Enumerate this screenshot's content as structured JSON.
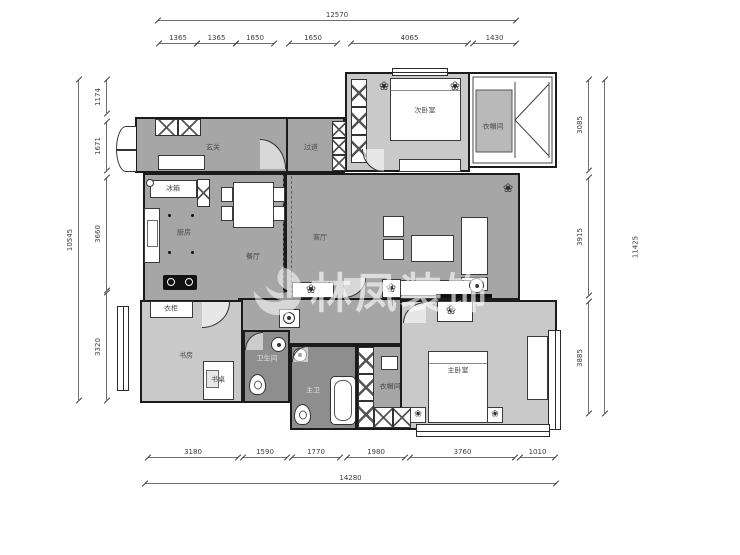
{
  "watermark": {
    "text": "林凤装饰"
  },
  "dimensions": {
    "top": {
      "overall": "12570",
      "segments": [
        "1365",
        "1365",
        "1650",
        "1650",
        "4065",
        "1430"
      ]
    },
    "bottom": {
      "overall": "14280",
      "segments": [
        "3180",
        "1590",
        "1770",
        "1980",
        "3760",
        "1010"
      ]
    },
    "left": {
      "overall": "10545",
      "segments": [
        "1174",
        "1671",
        "3660",
        "3320"
      ]
    },
    "right": {
      "overall": "11425",
      "segments": [
        "3085",
        "3915",
        "3885"
      ]
    }
  },
  "rooms": {
    "entry": "玄关",
    "passage": "过道",
    "bedroom2": "次卧室",
    "cloakroom_top": "衣帽间",
    "living": "客厅",
    "dining": "餐厅",
    "kitchen": "厨房",
    "study": "书房",
    "bath_guest": "卫生间",
    "bath_master": "主卫",
    "cloakroom_master": "衣帽间",
    "master_bedroom": "主卧室"
  },
  "furniture": {
    "fridge": "冰箱",
    "wardrobe": "衣柜",
    "desk": "书桌"
  },
  "icons": {
    "plant": "❀"
  },
  "colors": {
    "floor_medium": "#a6a6a6",
    "floor_light": "#c9c9c9",
    "floor_dark": "#8e8e8e",
    "wall": "#1b1b1b",
    "background": "#ffffff"
  }
}
